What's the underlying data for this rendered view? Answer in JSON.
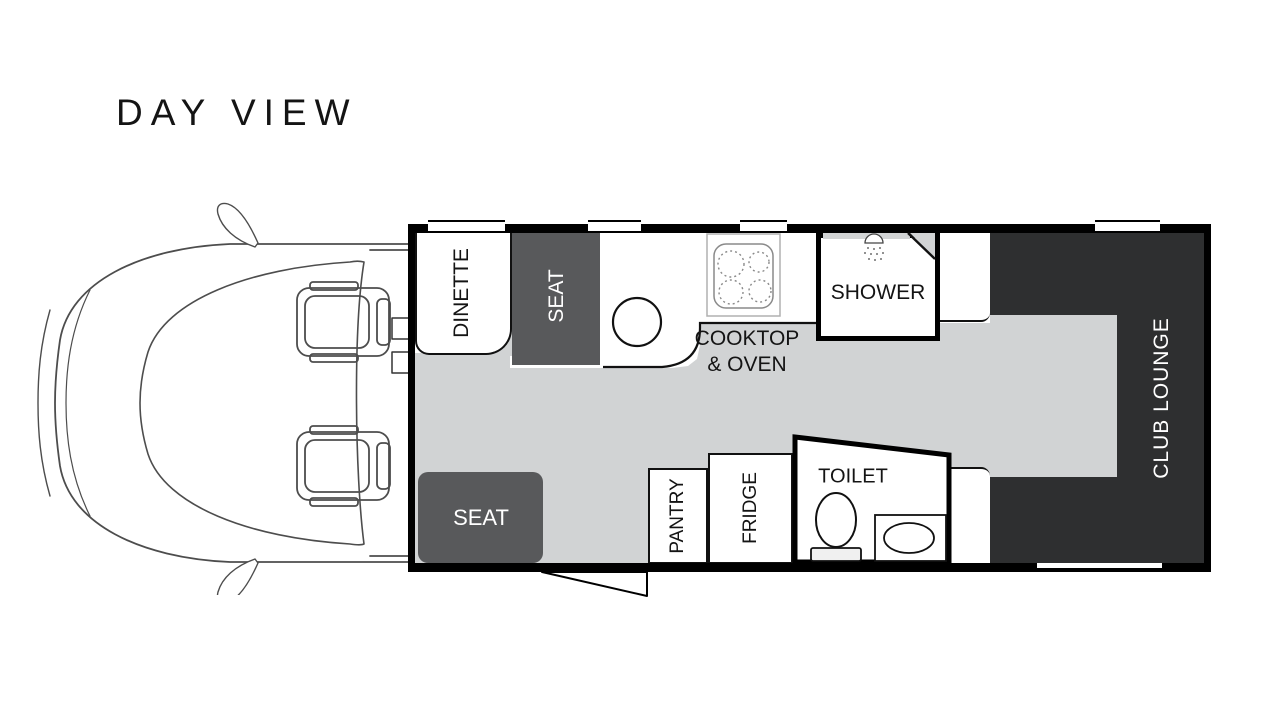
{
  "title": "DAY VIEW",
  "plan": {
    "dinette": "DINETTE",
    "seat_front": "SEAT",
    "cooktop_oven": "COOKTOP\n& OVEN",
    "shower": "SHOWER",
    "club_lounge": "CLUB LOUNGE",
    "seat_entry": "SEAT",
    "pantry": "PANTRY",
    "fridge": "FRIDGE",
    "toilet": "TOILET"
  },
  "colors": {
    "wall": "#000000",
    "floor": "#d1d3d4",
    "seat_block": "#58595b",
    "club_lounge": "#2e2f30",
    "line_art": "#4d4d4d",
    "label_dark": "#141414",
    "label_light": "#ffffff"
  },
  "icons": {
    "vehicle_cab": "vehicle-cab-top-view-line-art",
    "cab_seats": "two-cab-seats",
    "mirrors": "side-mirrors",
    "kitchen_sink": "round-sink",
    "cooktop": "four-burner-cooktop",
    "shower_head": "shower-head-spray",
    "toilet": "toilet-pedestal",
    "bathroom_basin": "oval-basin",
    "entry_door": "door-swing-leaf",
    "windows": "wall-window-gaps",
    "entry_steps": "side-entry-steps"
  }
}
